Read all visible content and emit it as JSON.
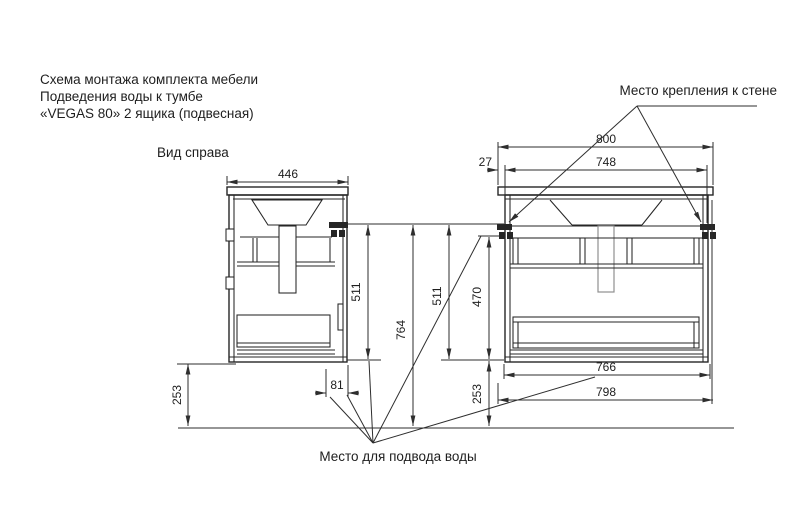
{
  "title": {
    "line1": "Схема монтажа комплекта мебели",
    "line2": "Подведения воды к тумбе",
    "line3": "«VEGAS 80» 2 ящика (подвесная)"
  },
  "labels": {
    "side_view": "Вид справа",
    "wall_mount": "Место крепления к стене",
    "water_supply": "Место для подвода воды"
  },
  "dimensions": {
    "side_depth": "446",
    "front_width": "800",
    "edge_offset": "27",
    "bracket_span": "748",
    "side_height": "511",
    "overall_height": "764",
    "front_height": "511",
    "inner_height": "470",
    "floor_clearance_left": "253",
    "floor_clearance_right": "253",
    "back_offset": "81",
    "inner_width": "766",
    "carcass_width": "798"
  },
  "colors": {
    "line": "#262626",
    "pipe": "#8f8f8f",
    "background": "#ffffff"
  }
}
